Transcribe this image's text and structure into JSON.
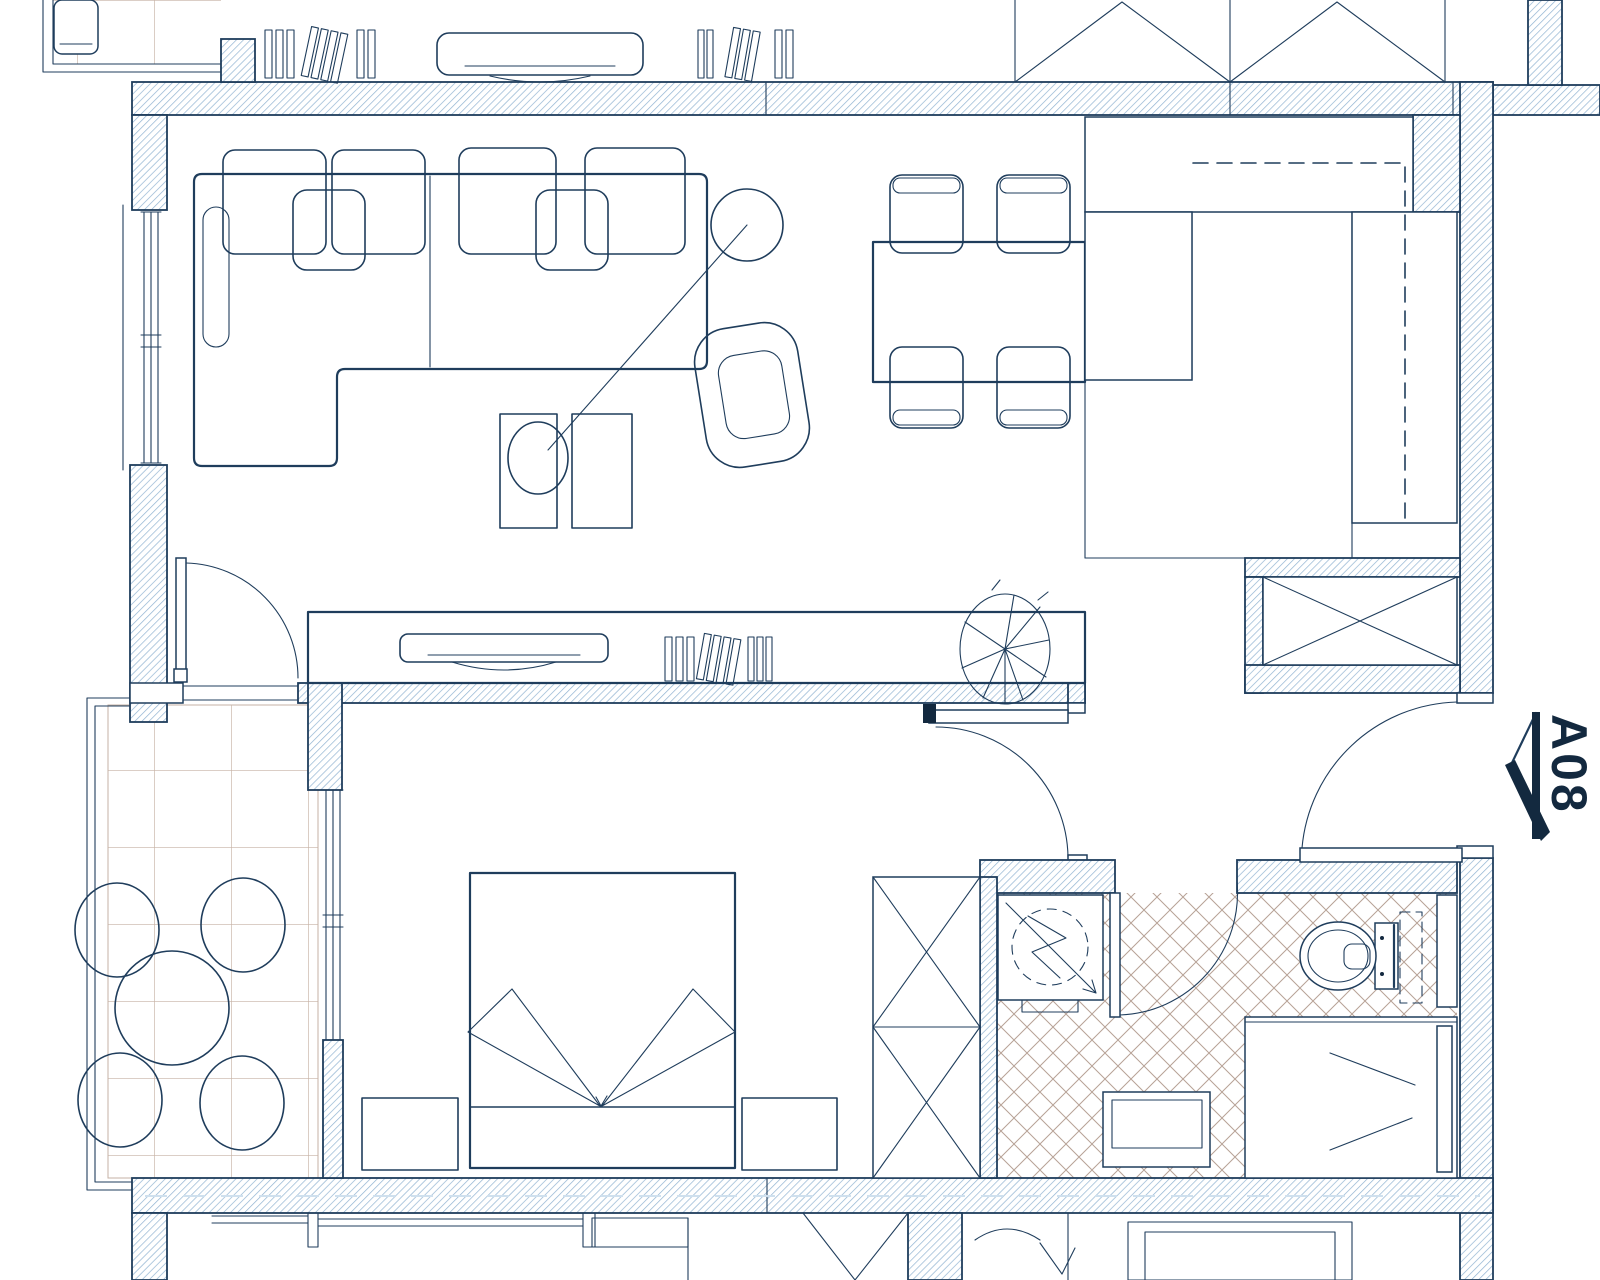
{
  "unit_label": "A08",
  "drawing": {
    "type": "apartment-floor-plan",
    "orientation": "top-down"
  },
  "colors": {
    "line": "#1f3d5c",
    "label": "#13293f",
    "wall_hatch": "#92b4d2",
    "tile_grid": "#c6b2a4",
    "floor_crosshatch": "#b7a296",
    "background": "#ffffff"
  },
  "rooms": [
    {
      "name": "living-room",
      "symbols": [
        "sectional-sofa",
        "back-cushions",
        "arc-floor-lamp",
        "armchair",
        "side-tables",
        "media-console",
        "tv",
        "books",
        "potted-plant"
      ]
    },
    {
      "name": "dining-area",
      "symbols": [
        "dining-table",
        "dining-chair",
        "dining-chair",
        "dining-chair",
        "dining-chair"
      ]
    },
    {
      "name": "kitchen",
      "symbols": [
        "l-shaped-counter",
        "upper-cabinets-dashed",
        "crosshatch-tile-floor"
      ]
    },
    {
      "name": "hallway",
      "symbols": [
        "built-in-wardrobe-x",
        "entry-door"
      ]
    },
    {
      "name": "bedroom",
      "symbols": [
        "double-bed",
        "blanket-fold",
        "nightstand",
        "nightstand",
        "wardrobe-x",
        "window"
      ]
    },
    {
      "name": "bathroom",
      "symbols": [
        "washing-machine",
        "toilet",
        "sink-vanity",
        "shower",
        "crosshatch-tile-floor"
      ]
    },
    {
      "name": "balcony",
      "symbols": [
        "round-table",
        "chair",
        "chair",
        "chair",
        "chair",
        "square-tile-floor"
      ]
    }
  ],
  "entry_marker": {
    "label": "A08",
    "arrow": "points-left-to-entry-door",
    "wall": "right"
  }
}
